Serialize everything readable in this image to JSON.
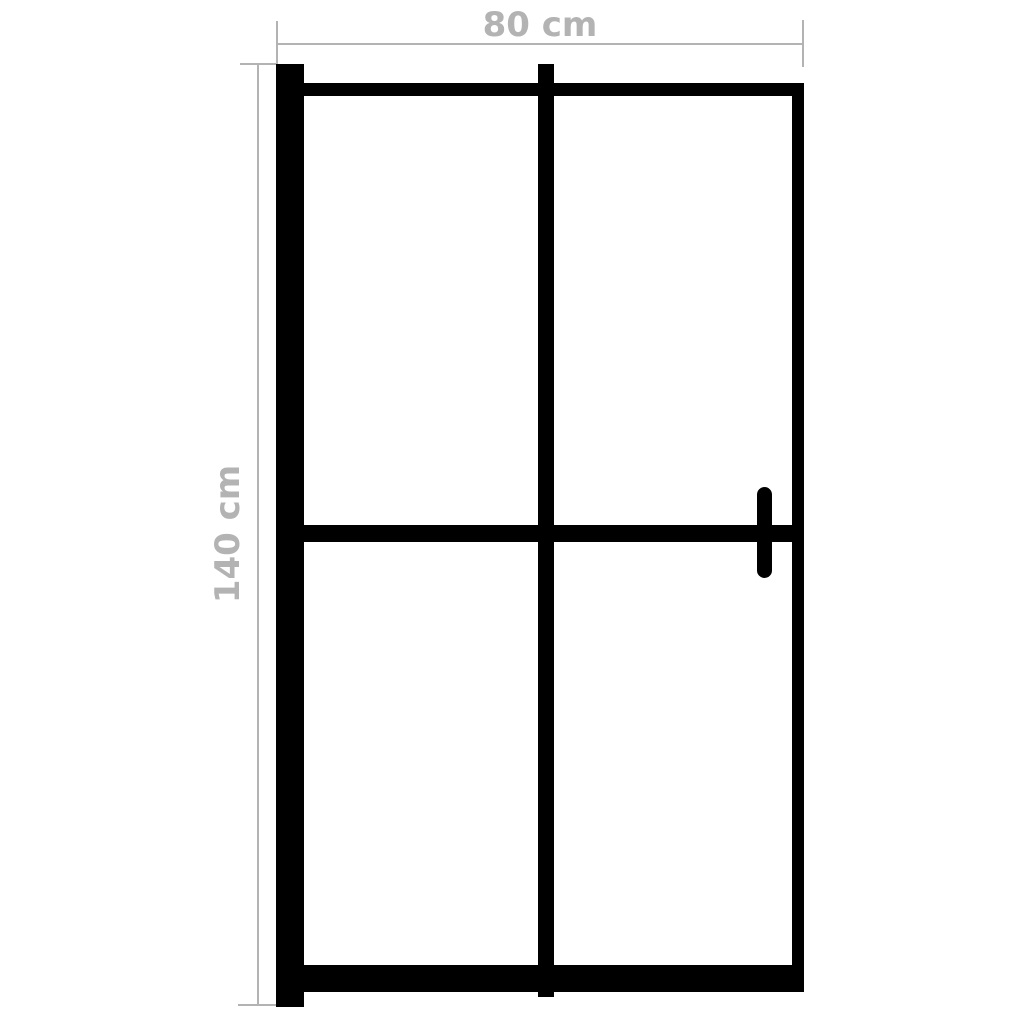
{
  "product_diagram": {
    "type": "shower-door-front-view",
    "background_color": "#ffffff",
    "frame_color": "#000000",
    "dimension_color": "#b3b3b3",
    "width_dimension": {
      "label": "80 cm",
      "value_cm": 80,
      "orientation": "horizontal",
      "position": "top"
    },
    "height_dimension": {
      "label": "140 cm",
      "value_cm": 140,
      "orientation": "vertical",
      "position": "left"
    },
    "frame_parts": [
      "wall-profile-bar",
      "top-rail",
      "right-stile",
      "bottom-rail",
      "center-mullion",
      "middle-crossbar",
      "door-handle"
    ]
  }
}
